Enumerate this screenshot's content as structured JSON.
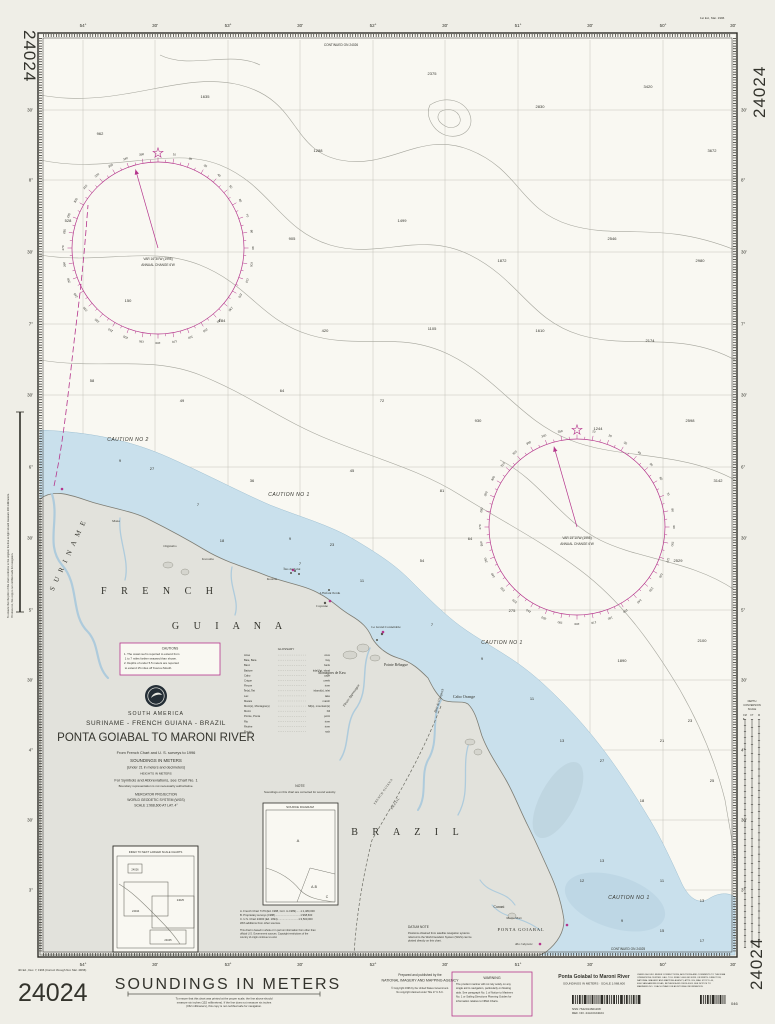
{
  "colors": {
    "magenta": "#b5358c",
    "water": "#c9e0ec",
    "water_dark": "#bdd3df",
    "land": "#e2e2dc",
    "contour": "#a6a69d",
    "sounding": "#68685f",
    "ink": "#2e2d28"
  },
  "chart_number": "24024",
  "margin_notes": {
    "top_right": "1st Ed., Mar. 1996",
    "edition": "4th Ed., Dec. 7, 1996 (Correct through Not. Mar. 49/96)",
    "left_vertical_1": "To ensure that the print of this chart conforms to the original, the line at right should measure 200 millimeters.",
    "left_vertical_2": "If it does not, this copy is not certified safe for navigation."
  },
  "grid": {
    "lon_labels": [
      {
        "t": "54°",
        "x": 83
      },
      {
        "t": "30'",
        "x": 155
      },
      {
        "t": "53°",
        "x": 228
      },
      {
        "t": "30'",
        "x": 300
      },
      {
        "t": "52°",
        "x": 373
      },
      {
        "t": "30'",
        "x": 445
      },
      {
        "t": "51°",
        "x": 518
      },
      {
        "t": "30'",
        "x": 590
      },
      {
        "t": "50°",
        "x": 663
      },
      {
        "t": "30'",
        "x": 733
      }
    ],
    "lat_labels": [
      {
        "t": "30'",
        "y": 110
      },
      {
        "t": "8°",
        "y": 180
      },
      {
        "t": "30'",
        "y": 252
      },
      {
        "t": "7°",
        "y": 324
      },
      {
        "t": "30'",
        "y": 395
      },
      {
        "t": "6°",
        "y": 467
      },
      {
        "t": "30'",
        "y": 538
      },
      {
        "t": "5°",
        "y": 610
      },
      {
        "t": "30'",
        "y": 680
      },
      {
        "t": "4°",
        "y": 750
      },
      {
        "t": "30'",
        "y": 820
      },
      {
        "t": "3°",
        "y": 890
      }
    ]
  },
  "continuations": {
    "top": "CONTINUED ON 24026",
    "bottom": "CONTINUED ON 24025"
  },
  "roses": [
    {
      "cx": 158,
      "cy": 248,
      "r": 86,
      "lines": [
        "VAR 16°30'W (1995)",
        "ANNUAL CHANGE 6'W"
      ]
    },
    {
      "cx": 577,
      "cy": 527,
      "r": 88,
      "lines": [
        "VAR 15°10'W (1995)",
        "ANNUAL CHANGE 6'W"
      ]
    }
  ],
  "title_block": {
    "region": "SOUTH AMERICA",
    "countries": "SURINAME - FRENCH GUIANA - BRAZIL",
    "title": "PONTA GOIABAL  TO  MARONI RIVER",
    "source_line": "From French Chart and U. S. surveys to 1996",
    "soundings": "SOUNDINGS IN METERS",
    "soundings_sub": "(Under 21 in meters and decimeters)",
    "heights": "HEIGHTS IN METERS",
    "symbols_line": "For Symbols and Abbreviations, see Chart No. 1",
    "boundary_line": "Boundary representation is not necessarily authoritative.",
    "projection": "MERCATOR PROJECTION",
    "datum": "WORLD GEODETIC SYSTEM  (WGS)",
    "scale_line": "SCALE 1:968,600 AT LAT. 4°"
  },
  "cautions_box": {
    "title": "CAUTIONS",
    "lines": [
      "1.  The coast reef is reported to extend from",
      "     1 to 7 miles farther seaward than shown.",
      "2.  Depths of under 5.5 meters are reported",
      "     to extend 15 miles off Kourou Mouth."
    ]
  },
  "caution_labels": [
    {
      "t": "CAUTION NO 2",
      "x": 128,
      "y": 441
    },
    {
      "t": "CAUTION NO 1",
      "x": 289,
      "y": 496
    },
    {
      "t": "CAUTION NO 1",
      "x": 502,
      "y": 644
    },
    {
      "t": "CAUTION NO 1",
      "x": 629,
      "y": 899
    }
  ],
  "note_box": {
    "title": "NOTE",
    "line": "Soundings on this chart are corrected for sound velocity."
  },
  "datum_note": {
    "title": "DATUM NOTE",
    "lines": [
      "Positions obtained from satellite navigation systems",
      "referred to the World Geodetic System (WGS) can be",
      "plotted directly on this chart."
    ]
  },
  "source_diagram": {
    "title": "SOURCE DIAGRAM",
    "regions": {
      "a": "A",
      "ab": "A-B",
      "c": "C"
    },
    "legend": [
      "A.  French Chart 7179 (Ed. 1988, Corr. to 1989)......1:1,480,000",
      "B.  Proprietary surveys (1988)..................................1:968,600",
      "C.  U.S. Chart 24000 (Ed. 1994)............................1:3,500,000",
      "With additions from other sources."
    ],
    "copyright_lines": [
      "This chart is based in whole or in part on information from other than",
      "official U.S. Government sources.  Copyright restrictions of the",
      "country of origin continue to exist."
    ]
  },
  "index_box": {
    "title": "INDEX TO NEXT LARGER SCALE CHARTS",
    "labels": {
      "a": "24026",
      "b": "24044",
      "c": "24025",
      "d": "24045"
    }
  },
  "glossary": {
    "title": "GLOSSARY",
    "entries": [
      {
        "term": "Anse",
        "def": "cove"
      },
      {
        "term": "Baie, Baía",
        "def": "bay"
      },
      {
        "term": "Banc",
        "def": "bank"
      },
      {
        "term": "Batture",
        "def": "tidal flat, shoal"
      },
      {
        "term": "Cabo",
        "def": "cape"
      },
      {
        "term": "Crique",
        "def": "creek"
      },
      {
        "term": "Fleuve",
        "def": "river"
      },
      {
        "term": "Île(s), Îlet",
        "def": "island(s), islet"
      },
      {
        "term": "Lac",
        "def": "lake"
      },
      {
        "term": "Marais",
        "def": "marsh"
      },
      {
        "term": "Mont(s), Montagne(s)",
        "def": "hill(s), mountain(s)"
      },
      {
        "term": "Morro",
        "def": "hill"
      },
      {
        "term": "Pointe, Ponta",
        "def": "point"
      },
      {
        "term": "Rio",
        "def": "river"
      },
      {
        "term": "Rivière",
        "def": "river"
      },
      {
        "term": "Roche",
        "def": "rock"
      }
    ]
  },
  "depth_scale": {
    "header": [
      "DEPTH",
      "CONVERSION",
      "SCALE"
    ],
    "cols": [
      "FM",
      "FT",
      "M"
    ]
  },
  "place_labels": [
    {
      "t": "S U R I N A M E",
      "x": 70,
      "y": 556,
      "rot": -65,
      "size": 7,
      "sp": 2,
      "italic": false
    },
    {
      "t": "F  R  E  N  C  H",
      "x": 160,
      "y": 594,
      "size": 10,
      "sp": 6
    },
    {
      "t": "G  U  I  A  N  A",
      "x": 230,
      "y": 629,
      "size": 10,
      "sp": 6
    },
    {
      "t": "B  R  A  Z  I  L",
      "x": 408,
      "y": 835,
      "size": 10,
      "sp": 6
    },
    {
      "t": "PONTA GOIABAL",
      "x": 521,
      "y": 931,
      "size": 4.6,
      "sp": 0.8
    },
    {
      "t": "Cabo Orange",
      "x": 464,
      "y": 698,
      "size": 4.2
    },
    {
      "t": "Pointe Béhague",
      "x": 396,
      "y": 666,
      "size": 3.8
    },
    {
      "t": "Montagnes de Kaw",
      "x": 332,
      "y": 674,
      "size": 3.6
    },
    {
      "t": "L'Enfant Perdu",
      "x": 330,
      "y": 594,
      "size": 3.4
    },
    {
      "t": "Le Grand Connétable",
      "x": 386,
      "y": 628,
      "size": 3.4
    },
    {
      "t": "Baie de l'Oyapock",
      "x": 440,
      "y": 701,
      "rot": -72,
      "size": 3.4,
      "italic": true
    },
    {
      "t": "Fleuve Approuague",
      "x": 352,
      "y": 696,
      "rot": -55,
      "size": 3.4,
      "italic": true
    },
    {
      "t": "Cunani",
      "x": 499,
      "y": 908,
      "size": 3.8
    },
    {
      "t": "Morro Mari",
      "x": 514,
      "y": 919,
      "size": 3.2
    },
    {
      "t": "Rio Calçoene",
      "x": 524,
      "y": 945,
      "size": 3.2,
      "italic": true
    },
    {
      "t": "FRENCH GUIANA",
      "x": 384,
      "y": 792,
      "rot": -55,
      "size": 3,
      "sp": 0.5
    },
    {
      "t": "BRAZIL",
      "x": 396,
      "y": 804,
      "rot": -55,
      "size": 3,
      "sp": 0.5
    },
    {
      "t": "Kourou",
      "x": 272,
      "y": 580,
      "size": 3.4
    },
    {
      "t": "Cayenne",
      "x": 322,
      "y": 607,
      "size": 3.4
    },
    {
      "t": "Îles du Salut",
      "x": 292,
      "y": 570,
      "size": 3.4
    },
    {
      "t": "Iracoubo",
      "x": 208,
      "y": 560,
      "size": 3.4
    },
    {
      "t": "Organabo",
      "x": 170,
      "y": 547,
      "size": 3.4
    },
    {
      "t": "Mana",
      "x": 116,
      "y": 522,
      "size": 3.4
    }
  ],
  "soundings": [
    {
      "x": 100,
      "y": 135,
      "v": "962"
    },
    {
      "x": 205,
      "y": 98,
      "v": "1635"
    },
    {
      "x": 318,
      "y": 152,
      "v": "1288"
    },
    {
      "x": 432,
      "y": 75,
      "v": "2375"
    },
    {
      "x": 540,
      "y": 108,
      "v": "2830"
    },
    {
      "x": 648,
      "y": 88,
      "v": "3420"
    },
    {
      "x": 712,
      "y": 152,
      "v": "3672"
    },
    {
      "x": 68,
      "y": 222,
      "v": "528"
    },
    {
      "x": 292,
      "y": 240,
      "v": "905"
    },
    {
      "x": 402,
      "y": 222,
      "v": "1499"
    },
    {
      "x": 502,
      "y": 262,
      "v": "1872"
    },
    {
      "x": 612,
      "y": 240,
      "v": "2546"
    },
    {
      "x": 700,
      "y": 262,
      "v": "2980"
    },
    {
      "x": 128,
      "y": 302,
      "v": "150"
    },
    {
      "x": 222,
      "y": 322,
      "v": "184"
    },
    {
      "x": 325,
      "y": 332,
      "v": "420"
    },
    {
      "x": 432,
      "y": 330,
      "v": "1105"
    },
    {
      "x": 540,
      "y": 332,
      "v": "1610"
    },
    {
      "x": 650,
      "y": 342,
      "v": "2174"
    },
    {
      "x": 92,
      "y": 382,
      "v": "58"
    },
    {
      "x": 182,
      "y": 402,
      "v": "49"
    },
    {
      "x": 282,
      "y": 392,
      "v": "64"
    },
    {
      "x": 382,
      "y": 402,
      "v": "72"
    },
    {
      "x": 478,
      "y": 422,
      "v": "930"
    },
    {
      "x": 598,
      "y": 430,
      "v": "1244"
    },
    {
      "x": 690,
      "y": 422,
      "v": "2598"
    },
    {
      "x": 718,
      "y": 482,
      "v": "3142"
    },
    {
      "x": 152,
      "y": 470,
      "v": "27"
    },
    {
      "x": 252,
      "y": 482,
      "v": "36"
    },
    {
      "x": 352,
      "y": 472,
      "v": "45"
    },
    {
      "x": 442,
      "y": 492,
      "v": "81"
    },
    {
      "x": 678,
      "y": 562,
      "v": "2529"
    },
    {
      "x": 222,
      "y": 542,
      "v": "18"
    },
    {
      "x": 332,
      "y": 546,
      "v": "23"
    },
    {
      "x": 422,
      "y": 562,
      "v": "54"
    },
    {
      "x": 512,
      "y": 612,
      "v": "275"
    },
    {
      "x": 622,
      "y": 662,
      "v": "1890"
    },
    {
      "x": 702,
      "y": 642,
      "v": "2100"
    },
    {
      "x": 120,
      "y": 462,
      "v": "9"
    },
    {
      "x": 198,
      "y": 506,
      "v": "7"
    },
    {
      "x": 290,
      "y": 540,
      "v": "9"
    },
    {
      "x": 362,
      "y": 582,
      "v": "11"
    },
    {
      "x": 432,
      "y": 626,
      "v": "7"
    },
    {
      "x": 482,
      "y": 660,
      "v": "9"
    },
    {
      "x": 532,
      "y": 700,
      "v": "11"
    },
    {
      "x": 562,
      "y": 742,
      "v": "13"
    },
    {
      "x": 602,
      "y": 762,
      "v": "27"
    },
    {
      "x": 642,
      "y": 802,
      "v": "18"
    },
    {
      "x": 602,
      "y": 862,
      "v": "13"
    },
    {
      "x": 662,
      "y": 882,
      "v": "11"
    },
    {
      "x": 702,
      "y": 902,
      "v": "13"
    },
    {
      "x": 622,
      "y": 922,
      "v": "9"
    },
    {
      "x": 582,
      "y": 882,
      "v": "12"
    },
    {
      "x": 662,
      "y": 932,
      "v": "15"
    },
    {
      "x": 702,
      "y": 942,
      "v": "17"
    },
    {
      "x": 690,
      "y": 722,
      "v": "23"
    },
    {
      "x": 662,
      "y": 742,
      "v": "21"
    },
    {
      "x": 712,
      "y": 782,
      "v": "25"
    },
    {
      "x": 470,
      "y": 540,
      "v": "64"
    },
    {
      "x": 300,
      "y": 565,
      "v": "7"
    }
  ],
  "bottom_strip": {
    "soundings_banner": "SOUNDINGS  IN  METERS",
    "scale_note_lines": [
      "To ensure that this chart was printed at the proper scale, the line above should",
      "measure six inches (152 millimeters). If the line does not measure six inches",
      "(152 millimeters), this copy is not certified safe for navigation."
    ],
    "publisher_line1": "Prepared and published by the",
    "publisher_line2": "NATIONAL IMAGERY AND MAPPING AGENCY",
    "copyright_line1": "© Copyright 1996 by the United States Government.",
    "copyright_line2": "No copyright claimed under Title 17 U.S.C.",
    "warning": {
      "title": "WARNING",
      "lines": [
        "The prudent mariner will not rely solely on any",
        "single aid to navigation, particularly on floating",
        "aids. See paragraph No. 1 of Notice to Mariners",
        "No. 1 or Sailing Directions Planning Guides for",
        "information relative to NIMA Charts."
      ]
    },
    "chart_title": "Ponta Goiabal to Maroni River",
    "chart_subtitle": "SOUNDINGS IN METERS · SCALE 1:968,600",
    "small_print_lines": [
      "USERS SHOULD REFER CORRECTIONS, ADDITIONS AND COMMENTS TO THE NIMA",
      "OPERATIONS CENTER. CALL TOLL FREE 1-800-362-6289. OR WRITE: DIRECTOR,",
      "NATIONAL IMAGERY AND MAPPING AGENCY, ATTN: ISS, MAIL STOP D-44,",
      "4600 SANGAMORE ROAD, BETHESDA MD 20816-5003. SEE NOTICE TO",
      "MARINERS NO. 1 EACH YEAR FOR ADDITIONAL INFORMATION."
    ],
    "nsn": "NSN 7642014601168",
    "ref_no": "REF. NO. 24ACO24024",
    "stock_small": "046"
  }
}
